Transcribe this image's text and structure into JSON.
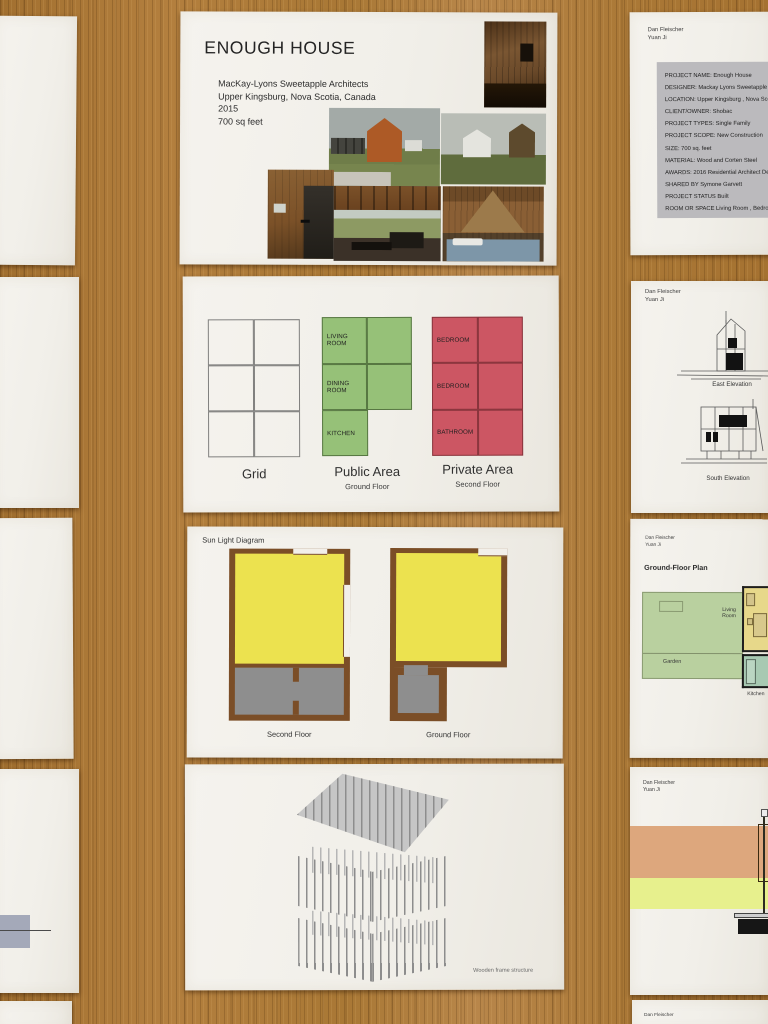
{
  "colors": {
    "wood": "#ac7a36",
    "paper": "#f3f1ea",
    "public_green": "#96c178",
    "private_red": "#cc5663",
    "sun_yellow": "#ece24f",
    "shade_gray": "#8e8e8e",
    "wall_brown": "#7b4e27",
    "garden_green": "#b9d09f",
    "living_yellow": "#e7d88a",
    "kitchen_green": "#a7c9b2",
    "band_orange": "#dda77d",
    "band_yellow": "#e7f08d",
    "info_box_gray": "#bbbabd"
  },
  "board1": {
    "title": "ENOUGH HOUSE",
    "architect": "MacKay-Lyons Sweetapple Architects",
    "location": "Upper Kingsburg, Nova Scotia, Canada",
    "year": "2015",
    "area": "700 sq feet"
  },
  "board2": {
    "grid_caption": "Grid",
    "public": {
      "caption": "Public Area",
      "subcaption": "Ground Floor",
      "rooms": [
        "LIVING ROOM",
        "DINING ROOM",
        "KITCHEN"
      ]
    },
    "private": {
      "caption": "Private Area",
      "subcaption": "Second Floor",
      "rooms": [
        "BEDROOM",
        "BEDROOM",
        "BATHROOM"
      ]
    }
  },
  "board3": {
    "title": "Sun Light Diagram",
    "second_floor_caption": "Second Floor",
    "ground_floor_caption": "Ground Floor"
  },
  "board4": {
    "caption": "Wooden frame structure"
  },
  "authors": {
    "line1": "Dan Fleischer",
    "line2": "Yuan Ji"
  },
  "info_sheet": {
    "rows": [
      "PROJECT NAME: Enough House",
      "DESIGNER: Mackay Lyons Sweetapple Architects",
      "LOCATION: Upper Kingsburg , Nova Scotia ,Canada",
      "CLIENT/OWNER: Shobac",
      "PROJECT TYPES: Single Family",
      "PROJECT SCOPE: New Construction",
      "SIZE: 700 sq. feet",
      "MATERIAL: Wood and Corten Steel",
      "AWARDS: 2016 Residential Architect Design Award",
      "SHARED BY Symone Garvett",
      "PROJECT STATUS Built",
      "ROOM OR SPACE Living Room , Bedroom"
    ]
  },
  "elevation_sheet": {
    "east_caption": "East Elevation",
    "south_caption": "South Elevation"
  },
  "plan_sheet": {
    "title": "Ground-Floor Plan",
    "garden": "Garden",
    "living_room": "Living Room",
    "kitchen": "Kitchen"
  }
}
